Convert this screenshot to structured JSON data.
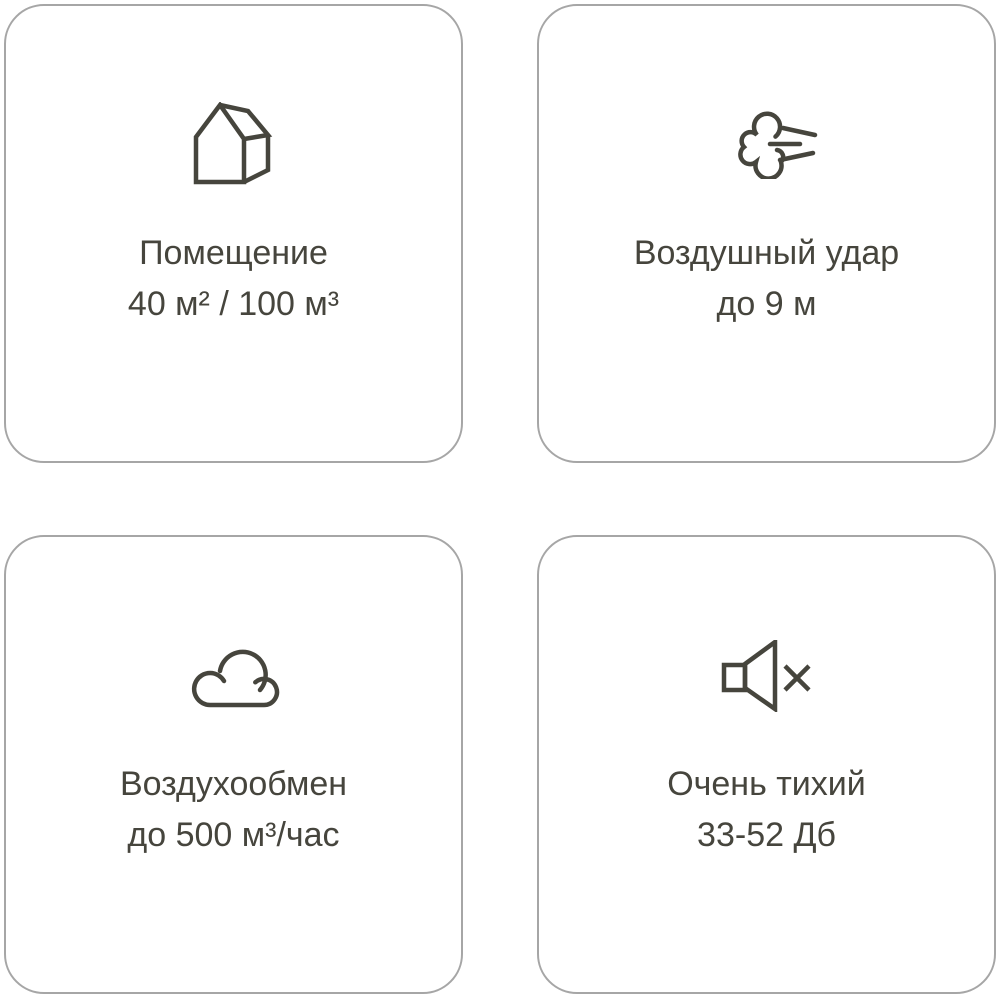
{
  "theme": {
    "background": "#ffffff",
    "card_border_color": "#a6a6a6",
    "text_color": "#46453d",
    "icon_stroke": "#46453d"
  },
  "cards": [
    {
      "icon": "house-icon",
      "title": "Помещение",
      "value": "40 м² / 100 м³"
    },
    {
      "icon": "air-blow-icon",
      "title": "Воздушный удар",
      "value": "до 9 м"
    },
    {
      "icon": "cloud-icon",
      "title": "Воздухообмен",
      "value": "до 500 м³/час"
    },
    {
      "icon": "muted-speaker-icon",
      "title": "Очень тихий",
      "value": "33-52 Дб"
    }
  ]
}
